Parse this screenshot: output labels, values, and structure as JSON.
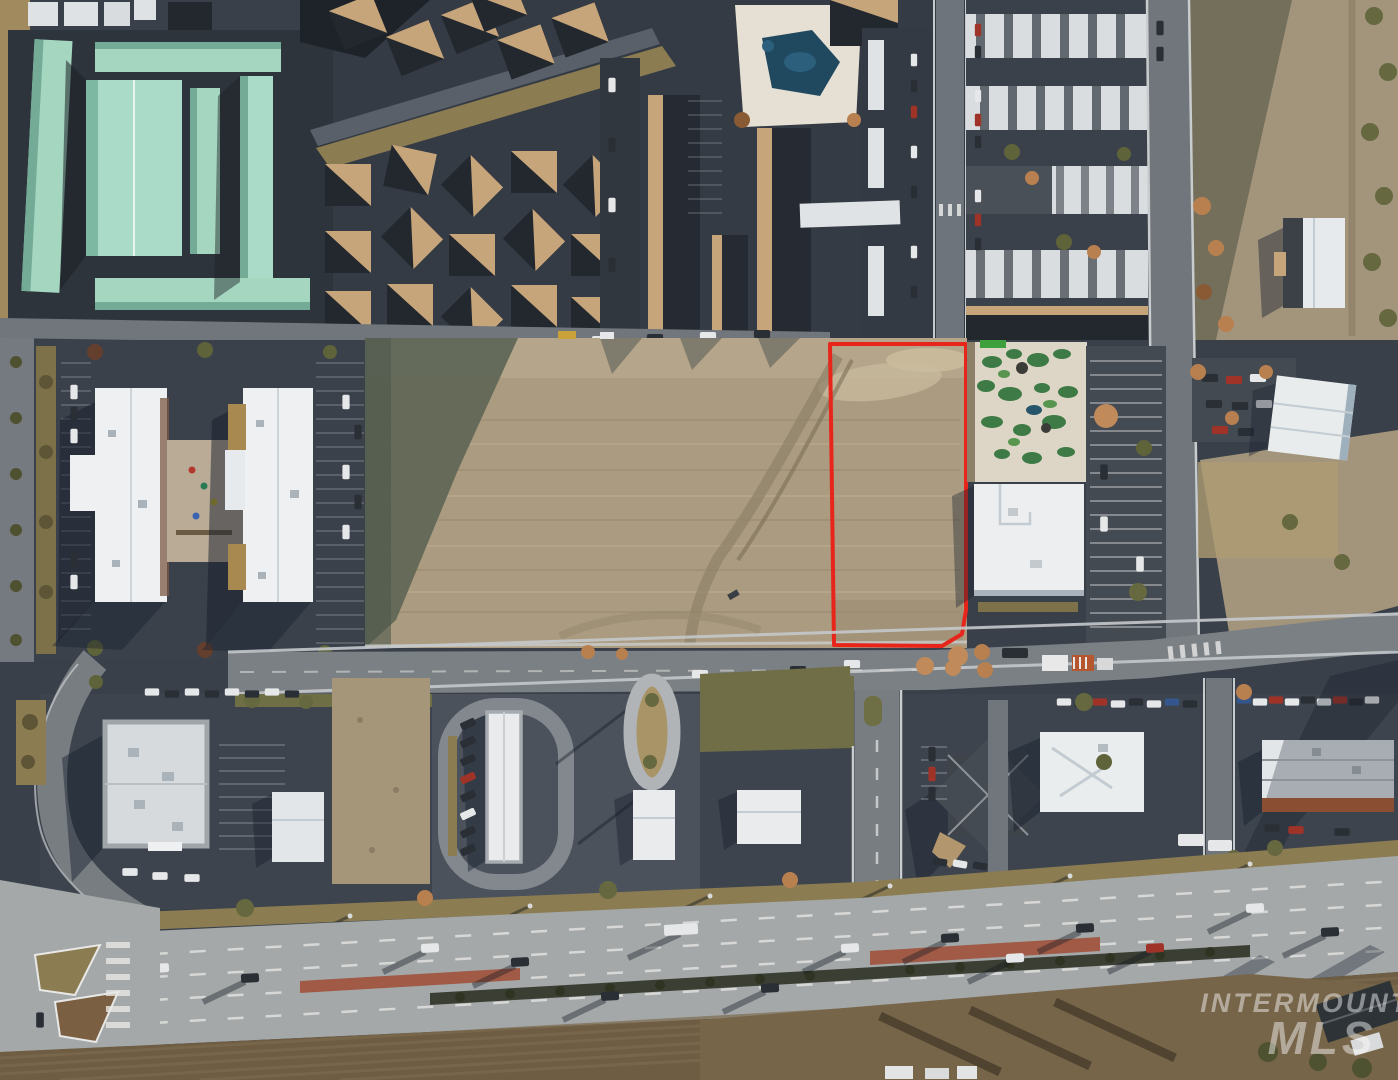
{
  "photo": {
    "type": "aerial-drone-photograph",
    "subject": "vacant commercial land parcel outlined in red within a developed retail and residential area"
  },
  "watermark": {
    "line1": "INTERMOUNTAIN",
    "line2": "MLS"
  },
  "parcel_outline": {
    "color": "#e8251b",
    "stroke_width": 4
  },
  "palette": {
    "asphalt_dark": "#39404a",
    "road_gray": "#787d82",
    "concrete_road": "#a4a8a9",
    "dirt": "#ab9b80",
    "dirt_light": "#c0af93",
    "dirt_shadow": "#5e6656",
    "teal_roof": "#a5d6c0",
    "white_roof": "#edeff0",
    "tan_roof": "#c7a57b",
    "dark_roof": "#23282f",
    "grass_olive": "#8c7c52",
    "median_red": "#a05a45",
    "minigolf_green": "#3e7a45",
    "pool_blue": "#20485e",
    "farmland": "#6e5c43"
  }
}
